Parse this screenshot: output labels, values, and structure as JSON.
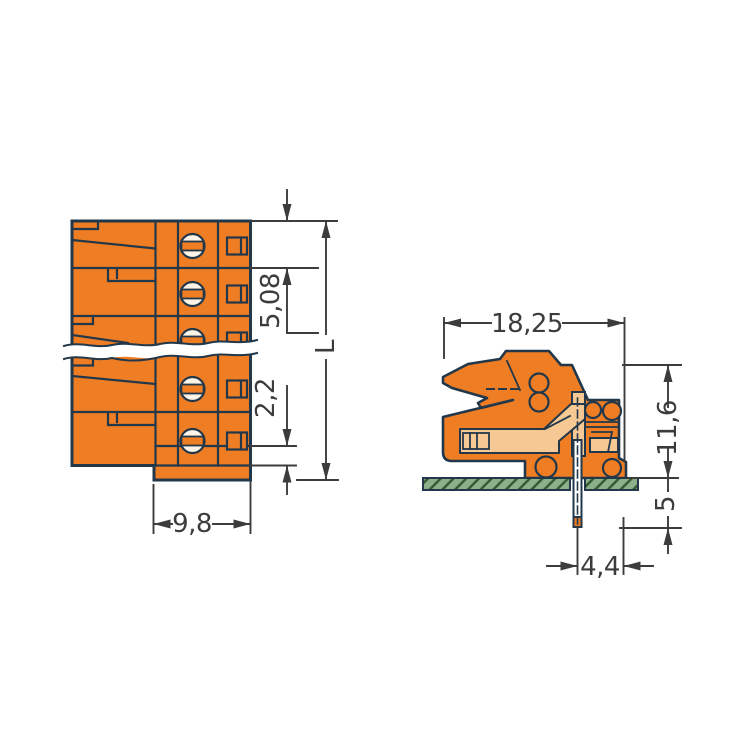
{
  "drawing": {
    "title": "connector-dimension-drawing",
    "colors": {
      "part_orange": "#ee7d23",
      "part_light": "#f6c894",
      "screw_light": "#fdf3e6",
      "outline": "#22384a",
      "dimension": "#3c3c3c",
      "board_green": "#8cb18a",
      "board_hatch": "#33582f",
      "background": "#ffffff"
    },
    "front_view": {
      "dim_pitch": "5,08",
      "dim_edge": "2,2",
      "dim_width": "9,8",
      "dim_length": "L"
    },
    "side_view": {
      "dim_depth": "18,25",
      "dim_height": "11,6",
      "dim_pin_length": "5",
      "dim_pin_offset": "4,4"
    }
  }
}
